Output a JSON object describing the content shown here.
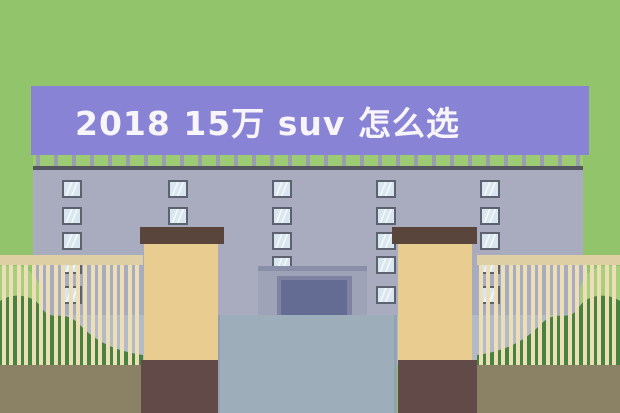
{
  "banner": {
    "title": "2018 15万 suv 怎么选"
  },
  "scene": {
    "subject": "cartoon building with gate pillars, fence and bushes",
    "window_rows": 5,
    "window_groups_per_row": 5,
    "panes_per_group": 4
  },
  "colors": {
    "sky": "#92c46b",
    "railGreen": "#9ccb74",
    "post": "#9a9cb0",
    "banner": "#8883d4",
    "bannerText": "#f7f5fa",
    "roof": "#55555f",
    "wall": "#a9acbf",
    "pavement": "#b4bac6",
    "winBorder": "#5c6270",
    "glassA": "#d9e6ef",
    "glassB": "#f0f6fa",
    "portalBand": "#8a8fa9",
    "portalRecess": "#9ea3b8",
    "doorFrame": "#7d83a1",
    "door": "#646c94",
    "drive": "#9dadb9",
    "driveEdge": "#93a2af",
    "cap": "#5a453c",
    "shaft": "#e9cd90",
    "base": "#614a47",
    "rail": "#decfa5",
    "bar": "#ecdfb8",
    "bushLight": "#a9cf7d",
    "bushDark": "#47833f",
    "ground": "#8b8266"
  }
}
